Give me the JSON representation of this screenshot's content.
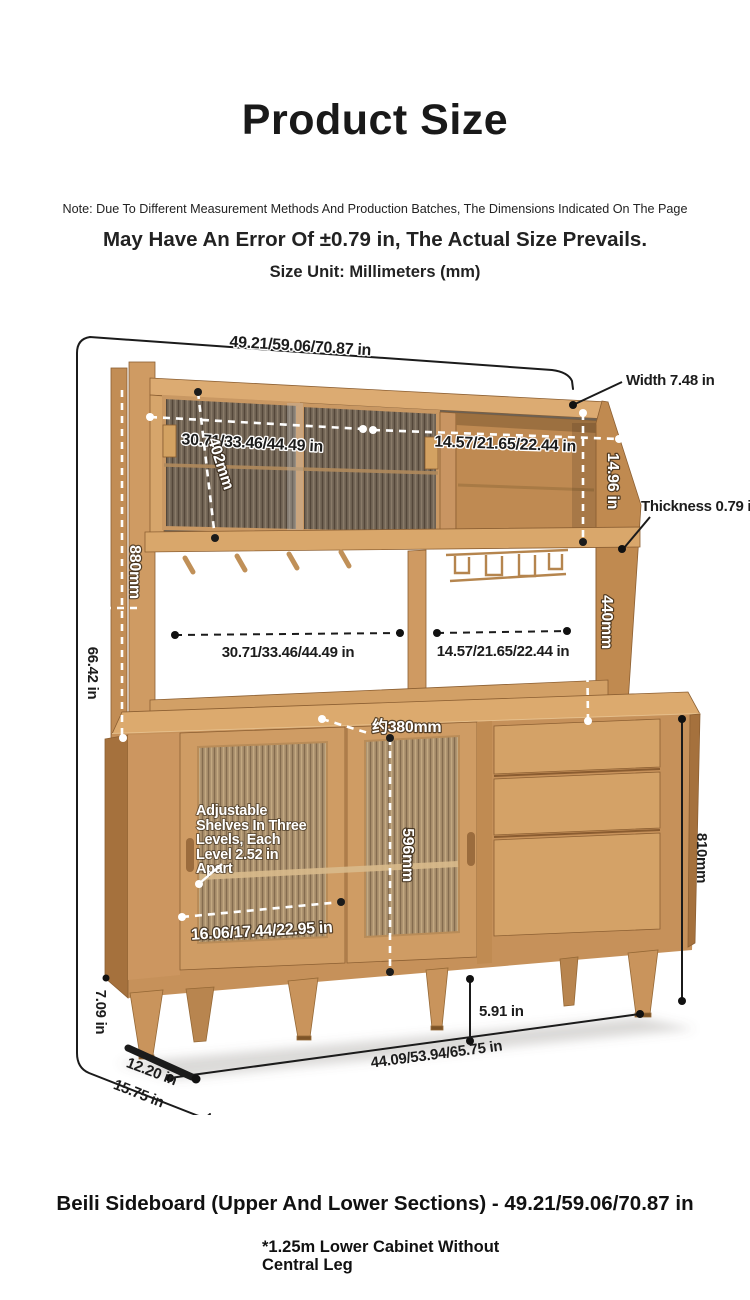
{
  "header": {
    "title": "Product Size",
    "note_line": "Note: Due To Different Measurement Methods And Production Batches, The Dimensions Indicated On The Page",
    "error_line": "May Have An Error Of ±0.79 in, The Actual Size Prevails.",
    "unit_line": "Size Unit: Millimeters (mm)"
  },
  "dimensions": {
    "overall_width": "49.21/59.06/70.87 in",
    "overall_height": "66.42 in",
    "top_depth": "Width 7.48 in",
    "shelf_thickness": "Thickness 0.79 in",
    "upper_glass_width": "30.71/33.46/44.49 in",
    "upper_cubby_width": "14.57/21.65/22.44 in",
    "upper_door_height": "402mm",
    "upper_cabinet_height": "14.96 in",
    "hutch_height": "880mm",
    "open_shelf_height": "440mm",
    "open_left_width": "30.71/33.46/44.49 in",
    "open_right_width": "14.57/21.65/22.44 in",
    "counter_depth": "约380mm",
    "lower_door_height": "596mm",
    "lower_cabinet_height": "810mm",
    "lower_door_width": "16.06/17.44/22.95 in",
    "shelf_note_line1": "Adjustable",
    "shelf_note_line2": "Shelves In Three",
    "shelf_note_line3": "Levels, Each",
    "shelf_note_line4": "Level 2.52 in",
    "shelf_note_line5": "Apart",
    "leg_height_left": "7.09 in",
    "leg_height_right": "5.91 in",
    "base_width": "44.09/53.94/65.75 in",
    "base_depth_front": "12.20 in",
    "base_depth_total": "15.75 in"
  },
  "footer": {
    "product_title": "Beili Sideboard (Upper And Lower Sections) - 49.21/59.06/70.87 in",
    "footnote_line1": "*1.25m Lower Cabinet Without",
    "footnote_line2": "Central Leg"
  }
}
